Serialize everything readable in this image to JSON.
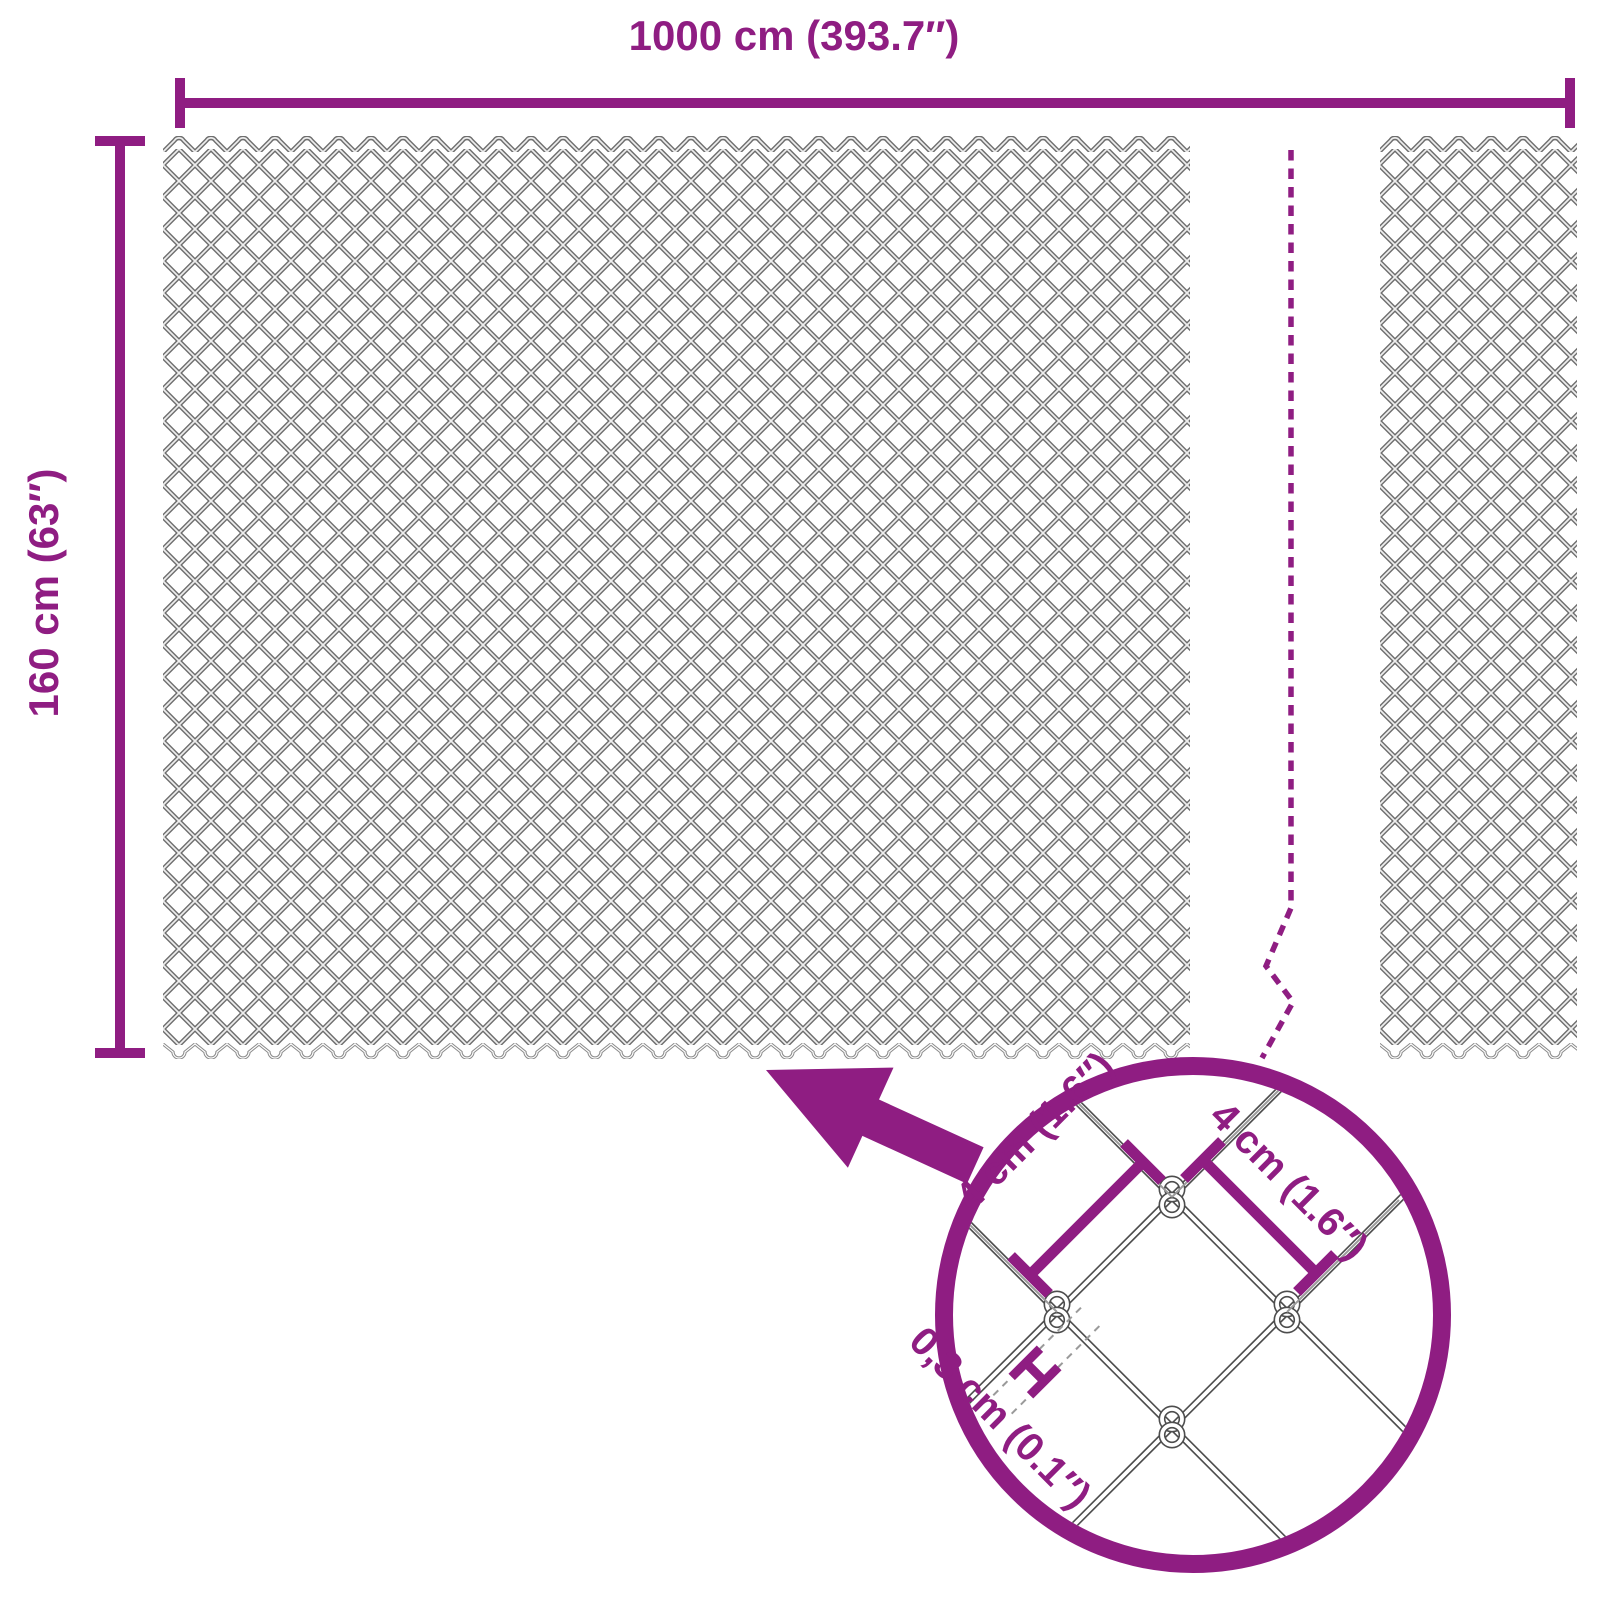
{
  "diagram": {
    "width_label": "1000 cm (393.7″)",
    "height_label": "160 cm (63″)",
    "detail_view": {
      "mesh_size_left_label": "4 cm (1.6″)",
      "mesh_size_right_label": "4 cm (1.6″)",
      "wire_thickness_label": "0,3 cm (0.1″)"
    },
    "colors": {
      "accent": "#8F1D82",
      "wire_dark": "#6E6E6E",
      "wire_light": "#EEEEEE",
      "magnified_wire_outline": "#4D4D4D"
    }
  }
}
